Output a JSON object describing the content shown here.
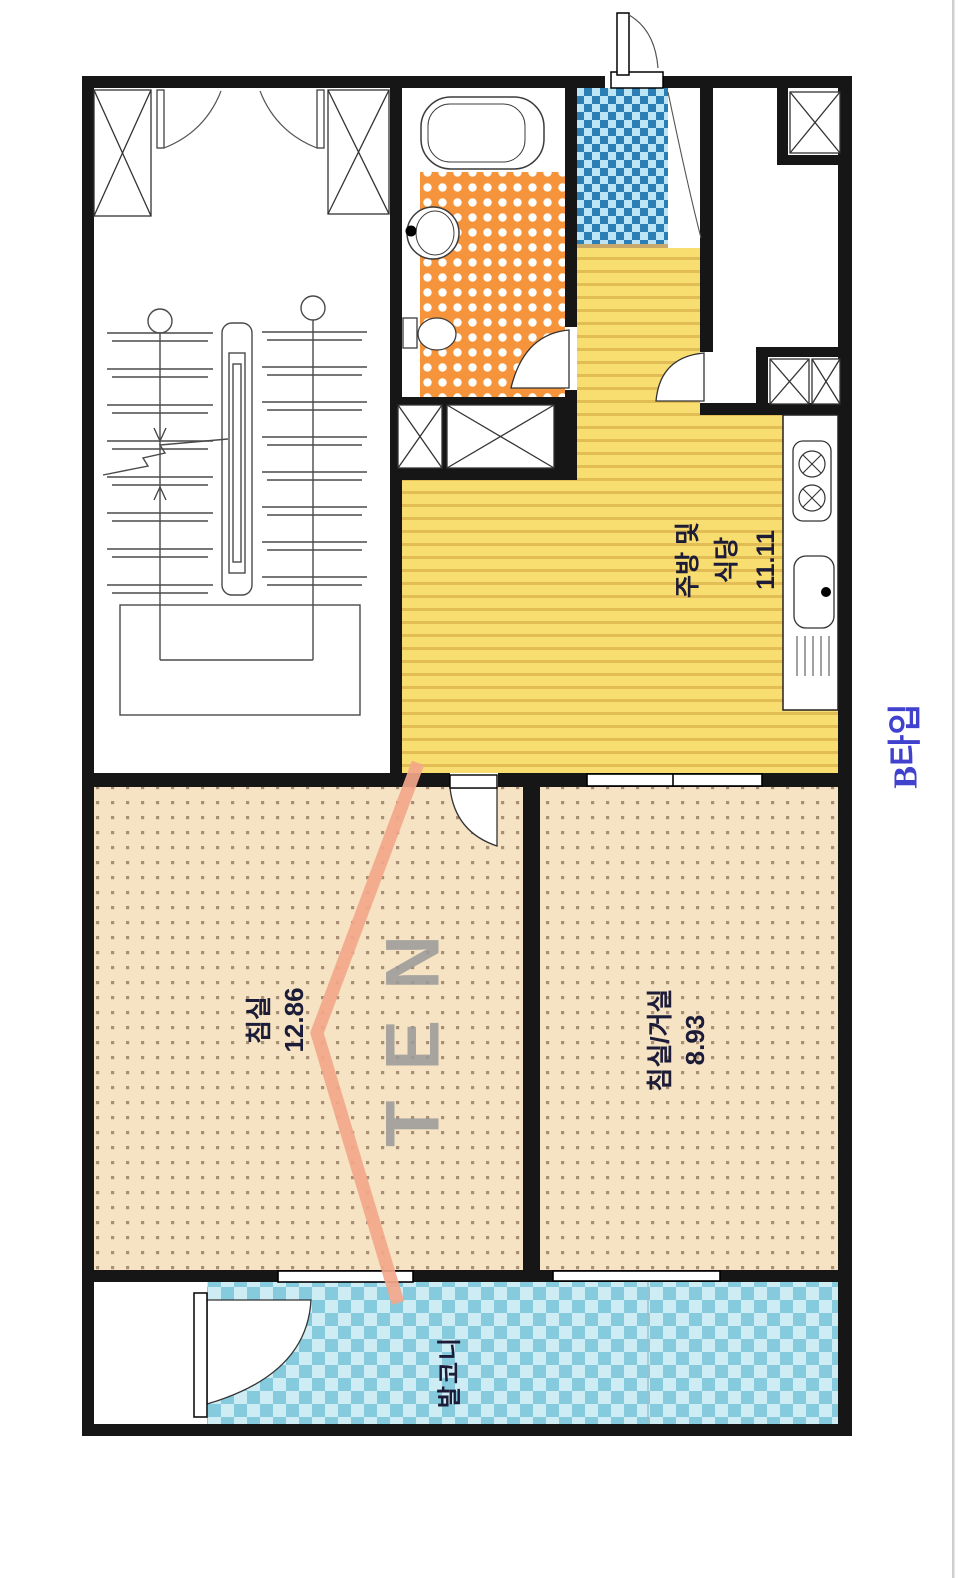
{
  "title": {
    "text": "B타입"
  },
  "watermark": {
    "text": "TEN"
  },
  "rooms": {
    "kitchen_dining": {
      "name_line1": "주방 및",
      "name_line2": "식당",
      "area": "11.11"
    },
    "bedroom": {
      "name": "침실",
      "area": "12.86"
    },
    "bedroom_living": {
      "name": "침실/거실",
      "area": "8.93"
    },
    "balcony": {
      "name": "발코니"
    }
  },
  "colors": {
    "wall": "#161616",
    "kitchen_floor": "#f8dd71",
    "kitchen_stripe": "#e2bc55",
    "bath_floor": "#f6943c",
    "bath_dot": "#ffffff",
    "bedroom_floor": "#f5e3c3",
    "bedroom_dot": "#a88e74",
    "entry_dark": "#2b7fb5",
    "entry_light": "#bce6f5",
    "balcony_dark": "#85cbdd",
    "balcony_light": "#cdecf4",
    "watermark_arrow": "#f3a78a",
    "watermark_text": "#9a9a9a",
    "title_text": "#4141cf",
    "label_text": "#1c1c38",
    "page_edge": "#cfcfcf"
  }
}
